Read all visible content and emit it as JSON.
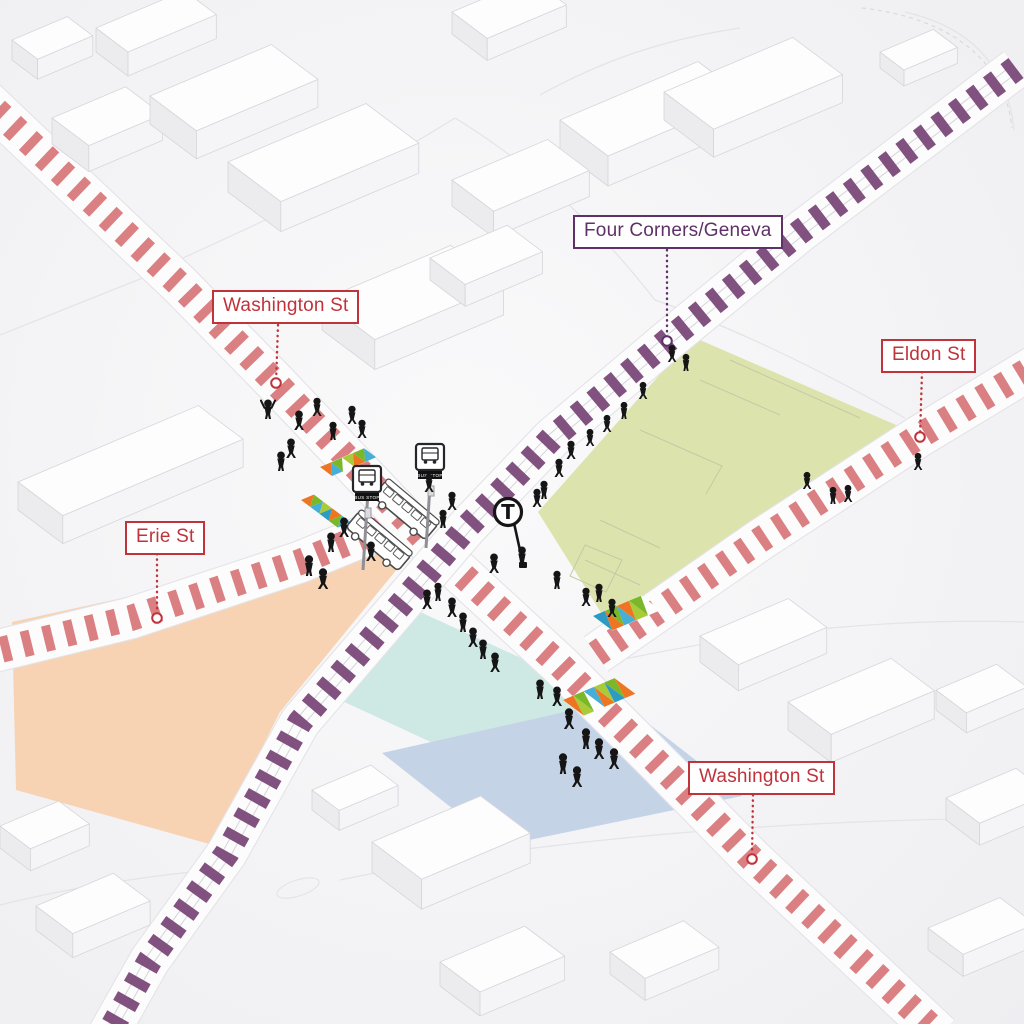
{
  "title": "Four Corners/Geneva intersection axonometric map",
  "labels": {
    "four_corners": {
      "text": "Four Corners/Geneva",
      "color": "#5E3168"
    },
    "washington_nw": {
      "text": "Washington St",
      "color": "#C0333A"
    },
    "eldon": {
      "text": "Eldon St",
      "color": "#C0333A"
    },
    "erie": {
      "text": "Erie St",
      "color": "#C0333A"
    },
    "washington_se": {
      "text": "Washington St",
      "color": "#C0333A"
    }
  },
  "markers": {
    "t_logo": "T",
    "bus_stop_sign": "BUS STOP"
  },
  "colors": {
    "background": "#F4F4F6",
    "street_dash": "#D9797B",
    "rail_dash": "#7A4878",
    "zone_peach": "#F8D3B3",
    "zone_cyan": "#CEE9E4",
    "zone_blue": "#C5D3E7",
    "zone_green": "#DDE3AC",
    "mosaic_orange": "#EE7623",
    "mosaic_green": "#7AB829",
    "mosaic_lime": "#A9CB3A",
    "mosaic_blue": "#45AFD5",
    "mosaic_teal": "#2E9BC4",
    "people": "#151515",
    "building_top": "#FDFDFE",
    "building_left": "#ECECEF",
    "building_right": "#F5F5F8",
    "building_edge": "#D6D6DB",
    "road_white": "#FCFCFD",
    "road_edge": "#E3E3E8",
    "label_red": "#C0333A",
    "label_purple": "#5E3168"
  }
}
